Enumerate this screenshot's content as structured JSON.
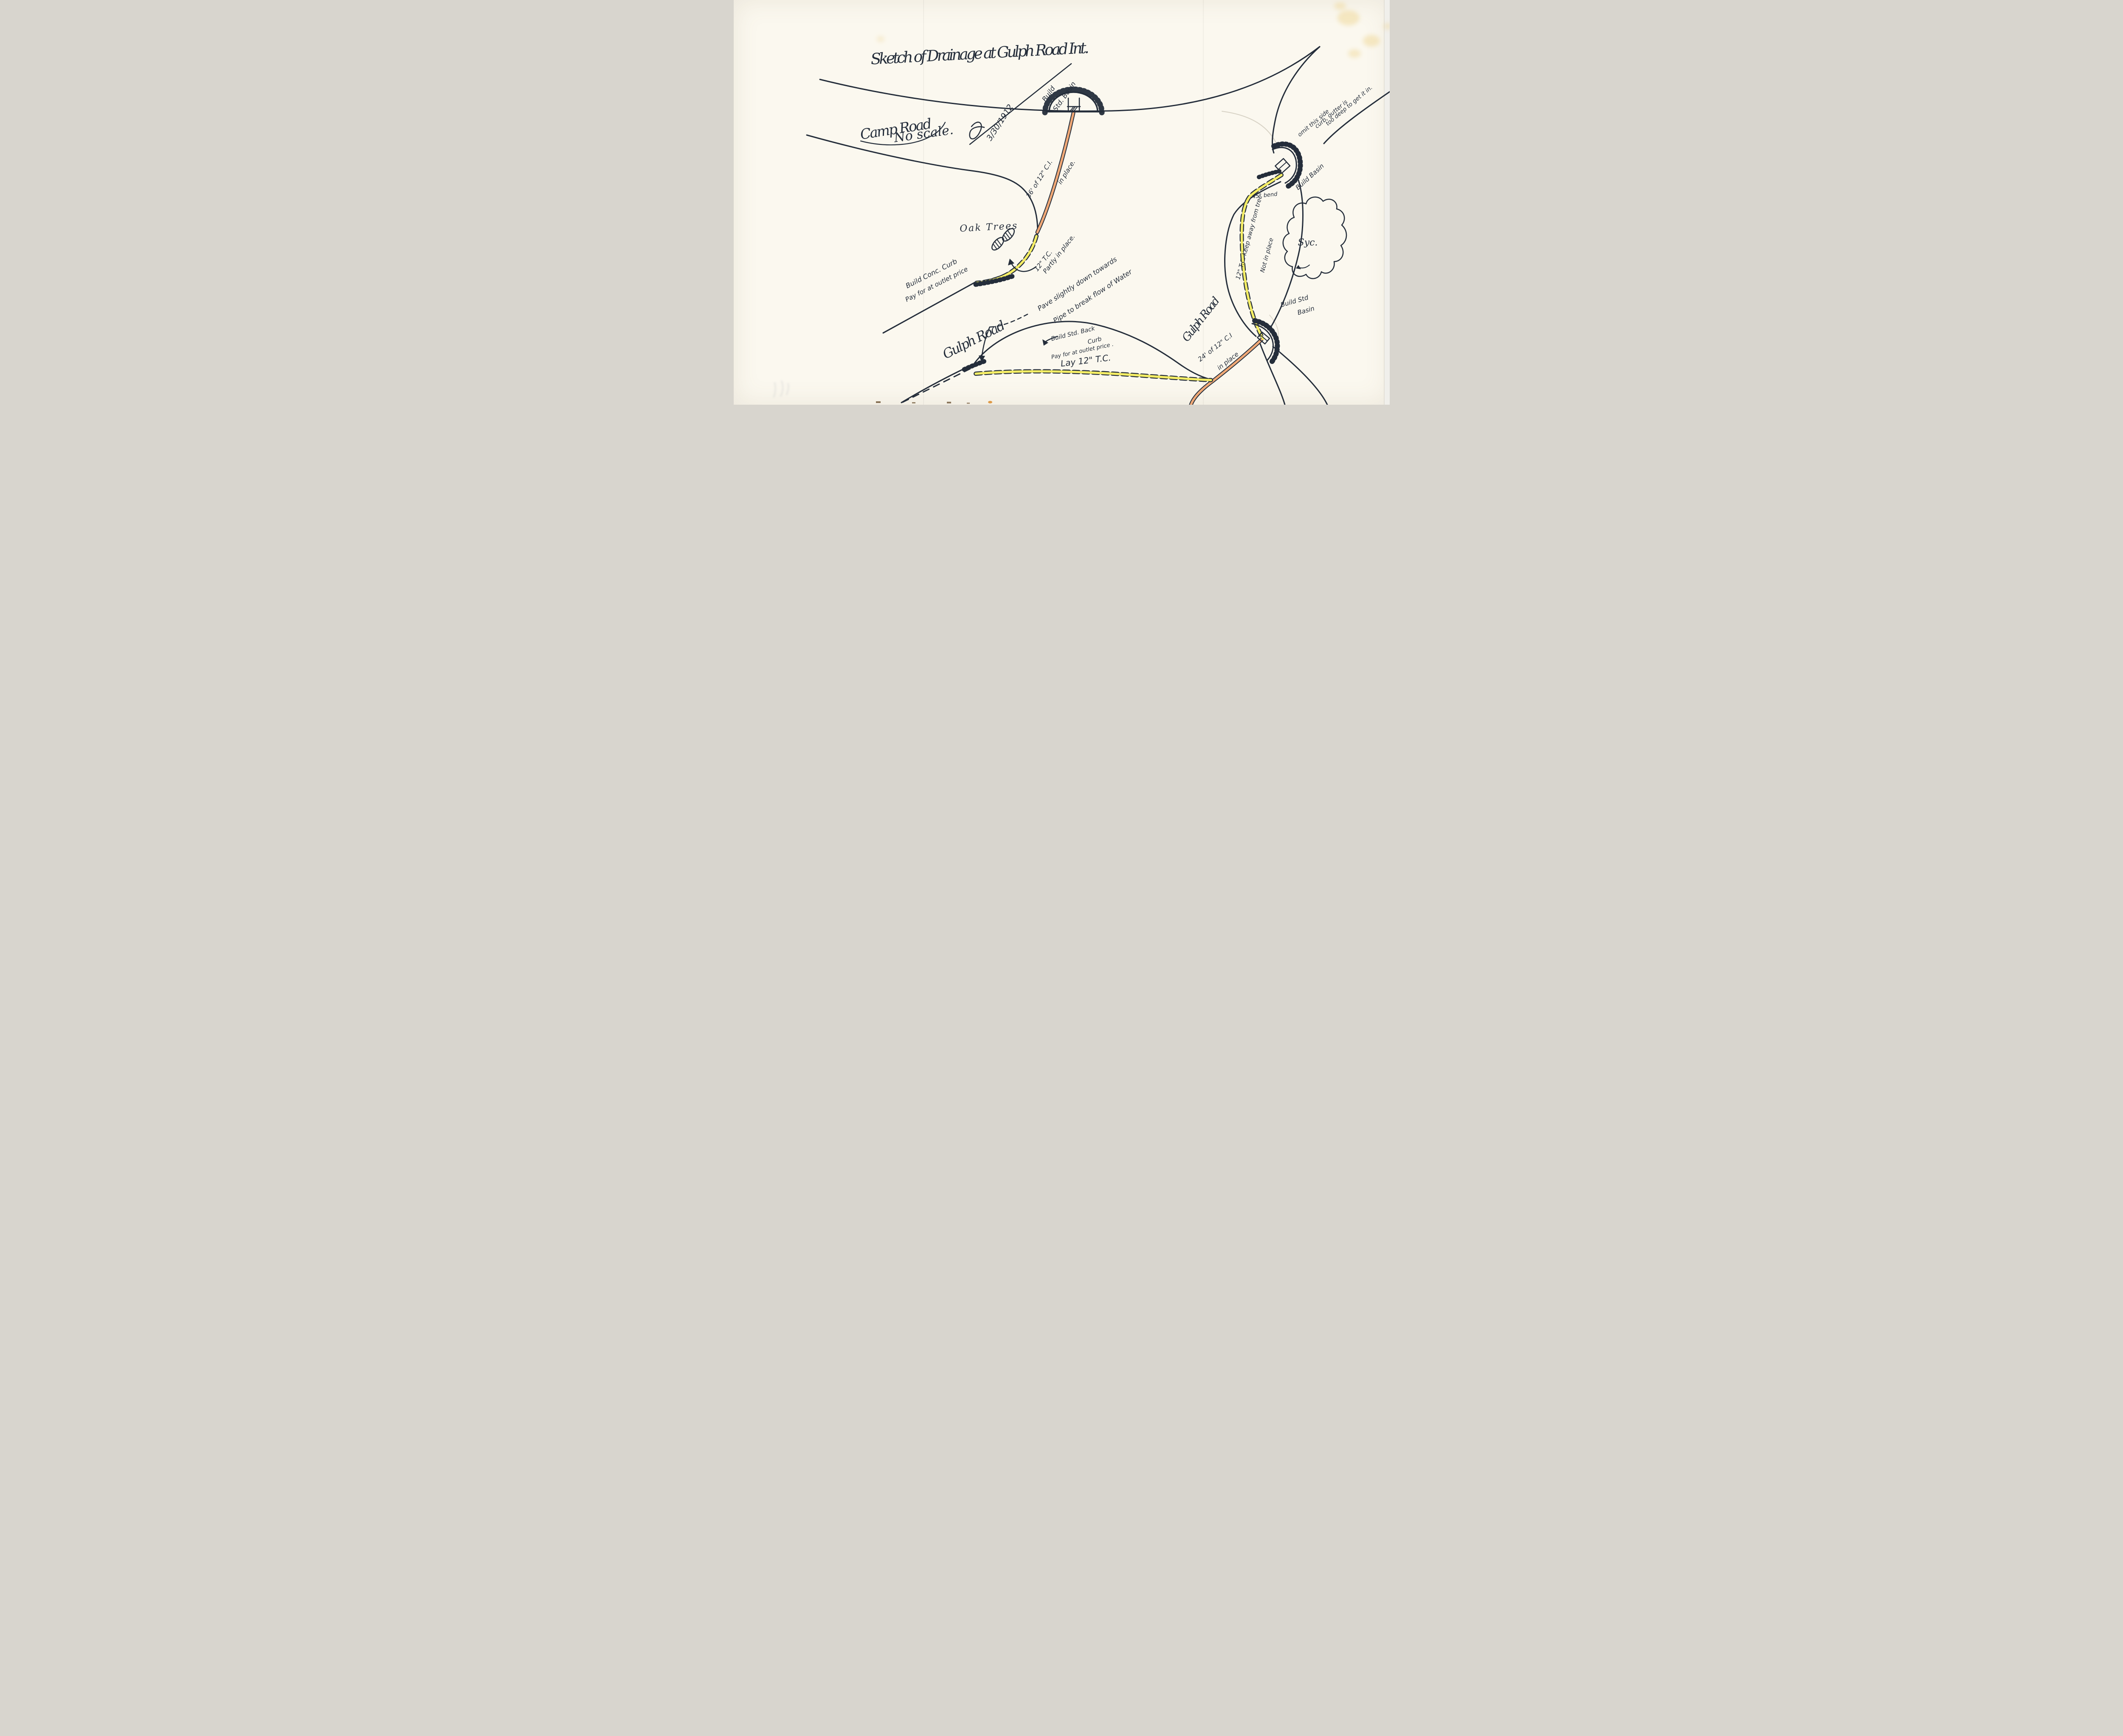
{
  "document": {
    "kind": "hand-drawn drainage sketch (scanned, 1912)",
    "title": "Sketch of Drainage at Gulph Road Int.",
    "scale_note": "No scale.",
    "date": "3/30/1912",
    "colors": {
      "paper": "#fbf8ef",
      "ink": "#242d3a",
      "cast_iron_pipe_in_place": "#f0a876",
      "terra_cotta_pipe": "#f6ee65",
      "pencil": "#b9b2a2",
      "stain": "#f0d794"
    }
  },
  "labels": {
    "camp_road": "Camp Road",
    "gulph_road": "Gulph Road",
    "gulph_road_right": "Gulph Road",
    "build_std_basin_top_1": "Build",
    "build_std_basin_top_2": "Std. Basin",
    "ci_top_1": "36' of 12\" C.I.",
    "ci_top_2": "in place.",
    "oak_trees": "Oak Trees",
    "tc_partly_1": "12\" T.C.",
    "tc_partly_2": "Partly in place.",
    "build_conc_curb_1": "Build Conc. Curb",
    "build_conc_curb_2": "Pay for at outlet price",
    "pave_1": "Pave slightly down towards",
    "pave_2": "Pipe to break flow of Water",
    "back_curb_1": "Build Std. Back",
    "back_curb_2": "Curb",
    "back_curb_3": "Pay for at outlet price .",
    "lay_tc": "Lay 12\" T.C.",
    "omit_1": "omit this side",
    "omit_2": "curb, gutter is",
    "omit_3": "too deep to get it in.",
    "build_basin_right": "Build Basin",
    "bend_45": "45° bend",
    "sycamore": "Syc.",
    "keep_away": "12\" T.C. Keep away from tree",
    "not_in_place": "Not in place",
    "ci_bottom_1": "24' of 12\" C.I",
    "ci_bottom_2": "in place",
    "build_std_basin_bottom_1": "Build Std",
    "build_std_basin_bottom_2": "Basin"
  }
}
